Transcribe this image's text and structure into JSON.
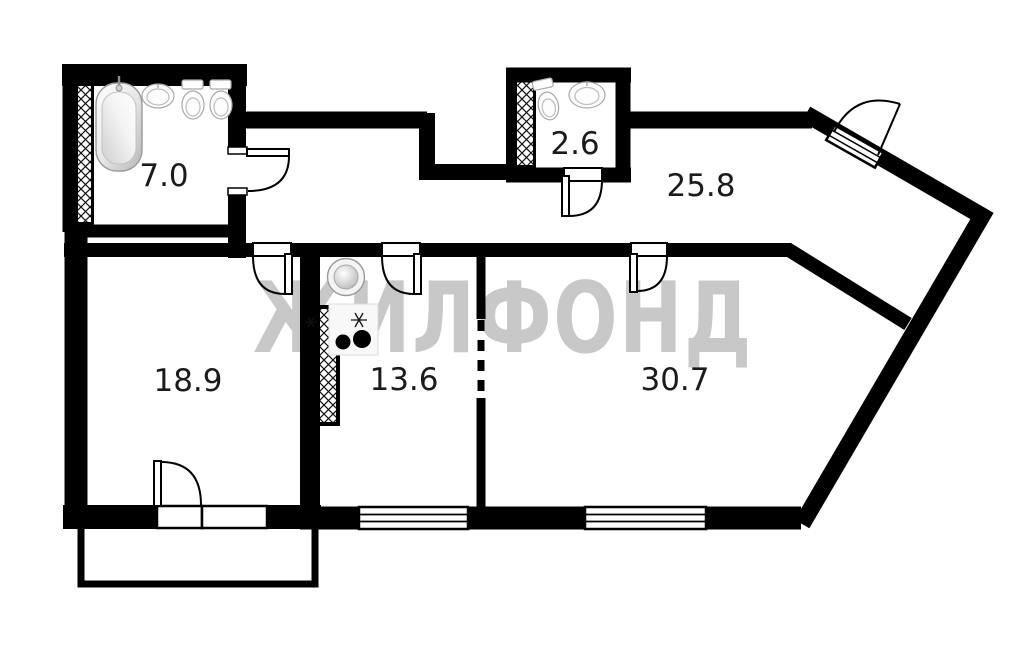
{
  "title": "apartment-floor-plan",
  "watermark": {
    "text": "ЖИЛФОНД",
    "color": "#c8c8c8"
  },
  "rooms": [
    {
      "name": "bathroom",
      "area": "7.0"
    },
    {
      "name": "wc",
      "area": "2.6"
    },
    {
      "name": "hall",
      "area": "25.8"
    },
    {
      "name": "room-left",
      "area": "18.9"
    },
    {
      "name": "kitchen",
      "area": "13.6"
    },
    {
      "name": "room-right",
      "area": "30.7"
    }
  ],
  "fixtures": [
    "bathtub",
    "bathroom-sink",
    "toilet",
    "bidet",
    "wc-toilet",
    "wc-sink",
    "kitchen-sink",
    "stove"
  ],
  "colors": {
    "background": "#ffffff",
    "walls": "#000000",
    "watermark": "#c8c8c8",
    "labels": "#1b1b1b",
    "fixture_stroke": "#a9a9a9"
  }
}
